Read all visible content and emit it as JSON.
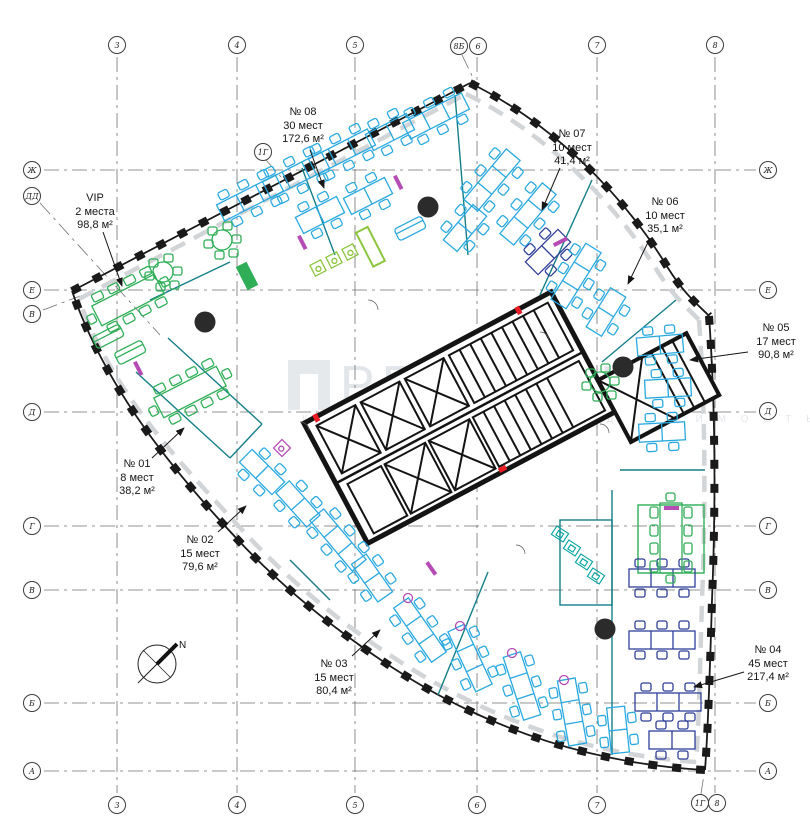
{
  "title": "Поэтажный план офиса",
  "watermark": {
    "brand": "PRAEDIUM",
    "subtitle": "К О М М Е Р Ч Е С К А Я   Н Е Д В И Ж И М О С Т Ь"
  },
  "compass": {
    "label": "N"
  },
  "zones": [
    {
      "id": "vip",
      "name": "VIP",
      "seats": "2 места",
      "area": "98,8 м²",
      "x": 95,
      "y": 192
    },
    {
      "id": "01",
      "name": "№ 01",
      "seats": "8 мест",
      "area": "38,2 м²",
      "x": 137,
      "y": 458
    },
    {
      "id": "02",
      "name": "№ 02",
      "seats": "15 мест",
      "area": "79,6 м²",
      "x": 200,
      "y": 534
    },
    {
      "id": "03",
      "name": "№ 03",
      "seats": "15 мест",
      "area": "80,4 м²",
      "x": 334,
      "y": 658
    },
    {
      "id": "04",
      "name": "№ 04",
      "seats": "45 мест",
      "area": "217,4 м²",
      "x": 768,
      "y": 644
    },
    {
      "id": "05",
      "name": "№ 05",
      "seats": "17 мест",
      "area": "90,8 м²",
      "x": 776,
      "y": 322
    },
    {
      "id": "06",
      "name": "№ 06",
      "seats": "10 мест",
      "area": "35,1 м²",
      "x": 665,
      "y": 196
    },
    {
      "id": "07",
      "name": "№ 07",
      "seats": "10 мест",
      "area": "41,4 м²",
      "x": 572,
      "y": 128
    },
    {
      "id": "08",
      "name": "№ 08",
      "seats": "30 мест",
      "area": "172,6 м²",
      "x": 303,
      "y": 106
    }
  ],
  "axes": {
    "bubbles": [
      {
        "label": "3",
        "x": 117,
        "y": 45
      },
      {
        "label": "4",
        "x": 237,
        "y": 45
      },
      {
        "label": "5",
        "x": 355,
        "y": 45
      },
      {
        "label": "8Б",
        "x": 459,
        "y": 46
      },
      {
        "label": "6",
        "x": 478,
        "y": 46
      },
      {
        "label": "7",
        "x": 597,
        "y": 45
      },
      {
        "label": "8",
        "x": 715,
        "y": 45
      },
      {
        "label": "1Г",
        "x": 263,
        "y": 152
      },
      {
        "label": "3",
        "x": 117,
        "y": 805
      },
      {
        "label": "4",
        "x": 237,
        "y": 805
      },
      {
        "label": "5",
        "x": 355,
        "y": 805
      },
      {
        "label": "6",
        "x": 477,
        "y": 805
      },
      {
        "label": "7",
        "x": 597,
        "y": 805
      },
      {
        "label": "1Г",
        "x": 700,
        "y": 803
      },
      {
        "label": "8",
        "x": 717,
        "y": 803
      },
      {
        "label": "Ж",
        "x": 32,
        "y": 170
      },
      {
        "label": "ДД",
        "x": 32,
        "y": 196
      },
      {
        "label": "Е",
        "x": 32,
        "y": 290
      },
      {
        "label": "В",
        "x": 32,
        "y": 314
      },
      {
        "label": "Д",
        "x": 32,
        "y": 412
      },
      {
        "label": "Г",
        "x": 32,
        "y": 526
      },
      {
        "label": "В",
        "x": 32,
        "y": 590
      },
      {
        "label": "Б",
        "x": 32,
        "y": 703
      },
      {
        "label": "А",
        "x": 32,
        "y": 771
      },
      {
        "label": "Ж",
        "x": 768,
        "y": 170
      },
      {
        "label": "Е",
        "x": 768,
        "y": 290
      },
      {
        "label": "Д",
        "x": 768,
        "y": 411
      },
      {
        "label": "Г",
        "x": 768,
        "y": 526
      },
      {
        "label": "В",
        "x": 768,
        "y": 590
      },
      {
        "label": "Б",
        "x": 768,
        "y": 703
      },
      {
        "label": "А",
        "x": 768,
        "y": 771
      }
    ]
  },
  "colors": {
    "cyan": "#2aa9e0",
    "blue": "#2f3f97",
    "teal": "#00a3a0",
    "green": "#2fae57",
    "lime": "#8cc63e",
    "magenta": "#b54cb5",
    "wall": "#157f89",
    "ink": "#1a1a1a"
  }
}
